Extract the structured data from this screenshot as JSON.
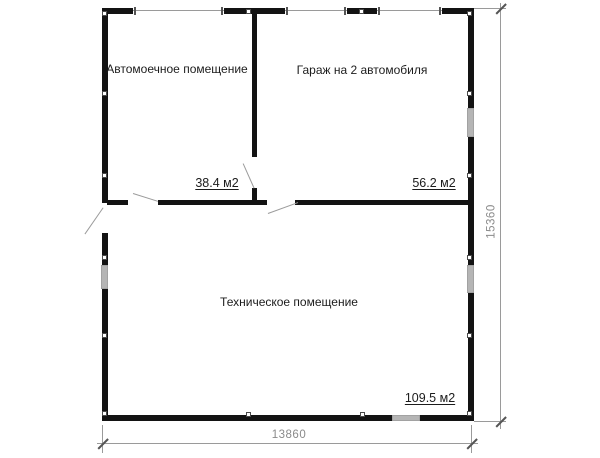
{
  "plan": {
    "title": "floor-plan",
    "rooms": [
      {
        "name": "Автомоечное помещение",
        "area": "38.4 м2"
      },
      {
        "name": "Гараж на 2 автомобиля",
        "area": "56.2 м2"
      },
      {
        "name": "Техническое помещение",
        "area": "109.5 м2"
      }
    ],
    "dimensions": {
      "width": "13860",
      "height": "15360"
    }
  },
  "colors": {
    "wall": "#131313",
    "opening_line": "#9a9a9a",
    "window_fill": "#b5b5b5",
    "dimension_line": "#9a9a9a",
    "dimension_text": "#8a8a8a",
    "label_text": "#1c1c1c"
  }
}
